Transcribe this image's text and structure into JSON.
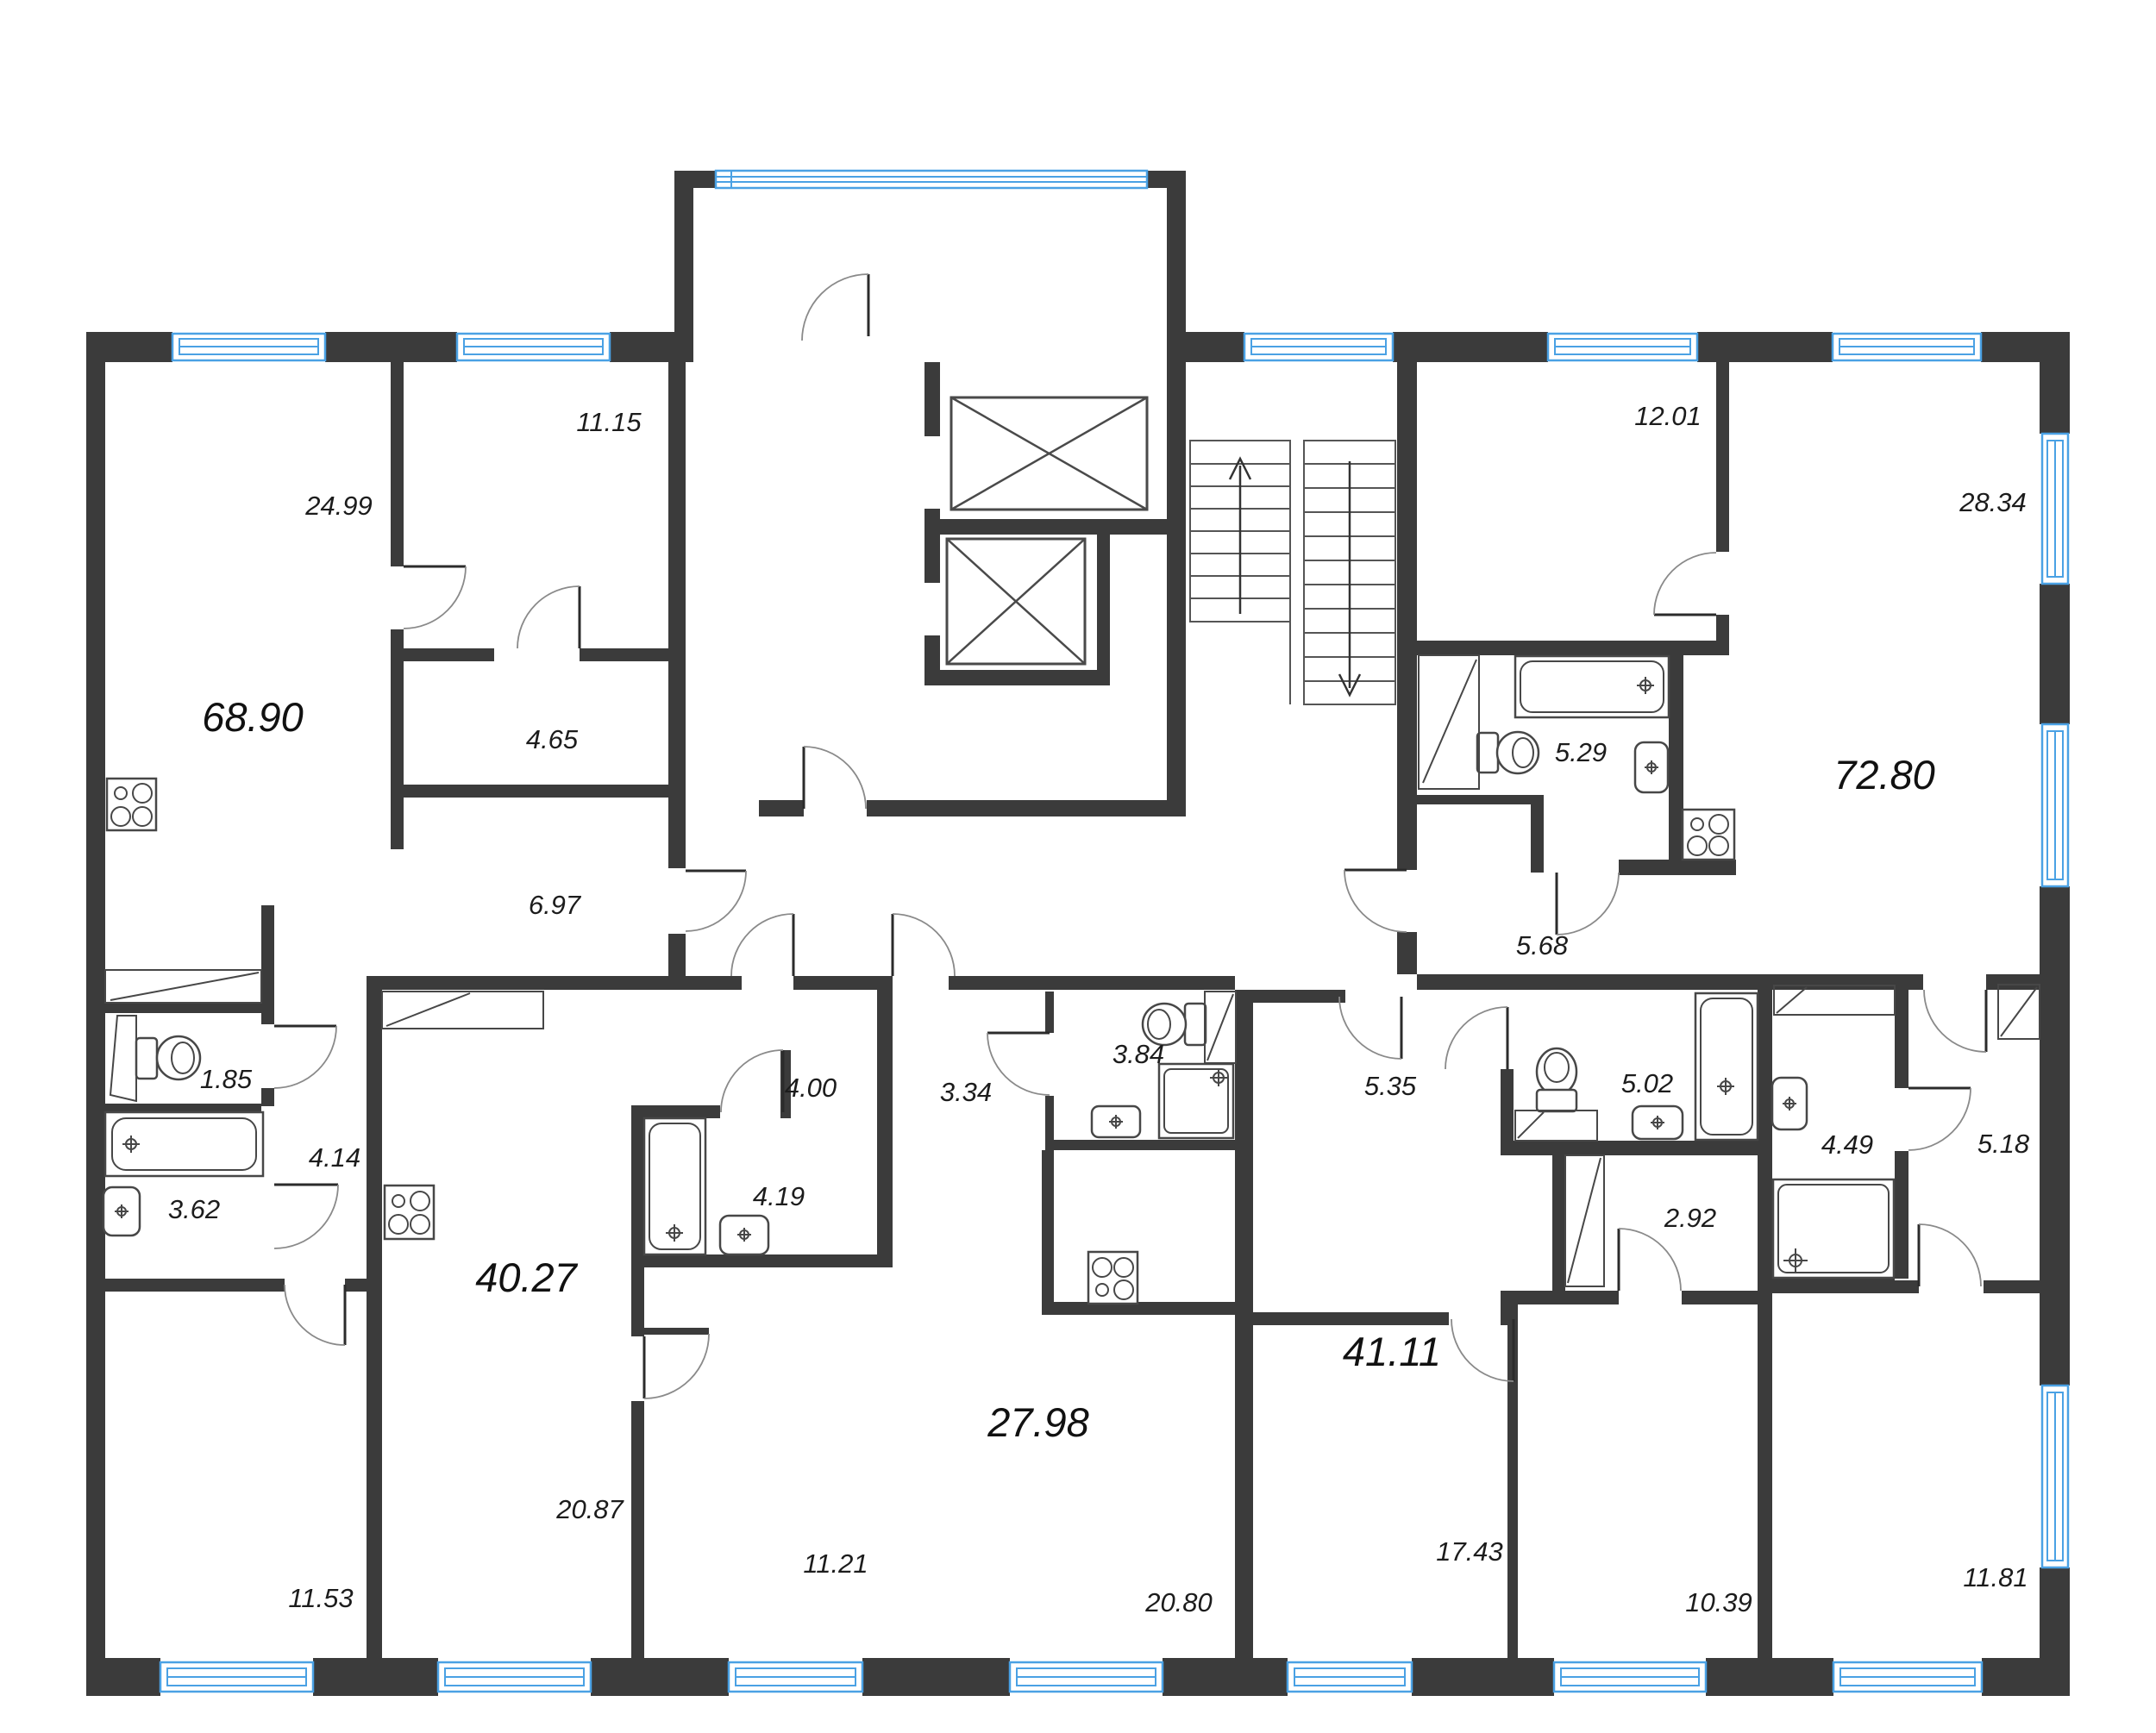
{
  "document": {
    "type": "residential-floor-plan",
    "units": "square-meters",
    "colors": {
      "wall": "#3b3b3b",
      "window_frame": "#4aa1e4",
      "fixture_line": "#474747",
      "door_arc": "#8a8a8a",
      "label_text": "#1c1c1c",
      "background": "#ffffff"
    }
  },
  "apartments": [
    {
      "total_area": "68.90",
      "room_areas": [
        "24.99",
        "11.15",
        "4.65",
        "6.97",
        "1.85",
        "3.62",
        "4.14",
        "11.53"
      ]
    },
    {
      "total_area": "40.27",
      "room_areas": [
        "20.87",
        "11.21",
        "4.19",
        "4.00"
      ]
    },
    {
      "total_area": "27.98",
      "room_areas": [
        "3.34",
        "3.84",
        "20.80"
      ]
    },
    {
      "total_area": "41.11",
      "room_areas": [
        "5.35",
        "5.02",
        "2.92",
        "17.43",
        "10.39"
      ]
    },
    {
      "total_area": "72.80",
      "room_areas": [
        "12.01",
        "28.34",
        "5.29",
        "5.68",
        "4.49",
        "5.18",
        "11.81"
      ]
    }
  ],
  "core_features": [
    "two-elevators",
    "double-flight-staircase",
    "entrance-vestibule",
    "corridor"
  ],
  "labels": [
    {
      "text": "68.90"
    },
    {
      "text": "40.27"
    },
    {
      "text": "27.98"
    },
    {
      "text": "41.11"
    },
    {
      "text": "72.80"
    },
    {
      "text": "24.99"
    },
    {
      "text": "11.15"
    },
    {
      "text": "4.65"
    },
    {
      "text": "6.97"
    },
    {
      "text": "1.85"
    },
    {
      "text": "4.14"
    },
    {
      "text": "3.62"
    },
    {
      "text": "11.53"
    },
    {
      "text": "12.01"
    },
    {
      "text": "28.34"
    },
    {
      "text": "5.29"
    },
    {
      "text": "5.68"
    },
    {
      "text": "20.87"
    },
    {
      "text": "11.21"
    },
    {
      "text": "4.19"
    },
    {
      "text": "4.00"
    },
    {
      "text": "3.34"
    },
    {
      "text": "3.84"
    },
    {
      "text": "20.80"
    },
    {
      "text": "5.35"
    },
    {
      "text": "5.02"
    },
    {
      "text": "2.92"
    },
    {
      "text": "17.43"
    },
    {
      "text": "10.39"
    },
    {
      "text": "4.49"
    },
    {
      "text": "5.18"
    },
    {
      "text": "11.81"
    }
  ]
}
